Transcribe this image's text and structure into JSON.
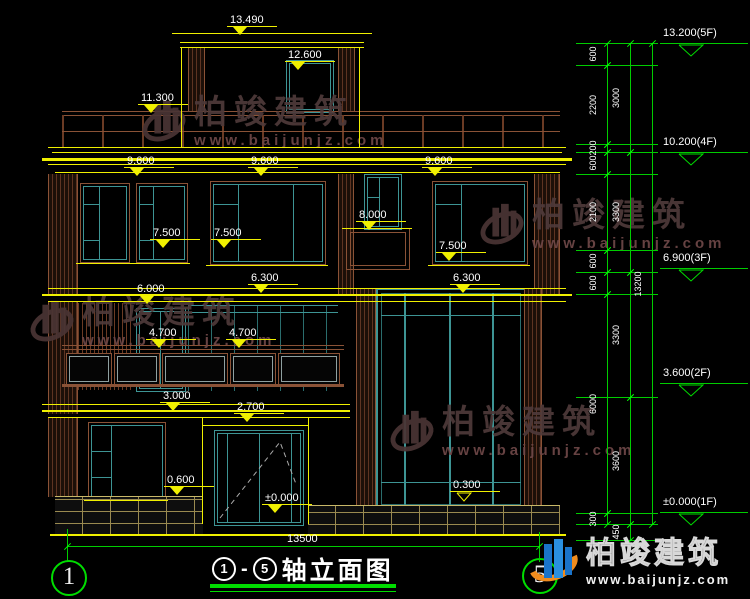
{
  "title": {
    "axis_from": "1",
    "dash": "-",
    "axis_to": "5",
    "text": "轴立面图"
  },
  "bottom": {
    "width_dim": "13500"
  },
  "axis_bubbles": {
    "left": "1",
    "right": "5"
  },
  "watermark": {
    "brand": "柏竣建筑",
    "url": "www.baijunjz.com"
  },
  "brand_logo": {
    "brand": "柏竣建筑",
    "url": "www.baijunjz.com"
  },
  "colors": {
    "cad_yellow": "#f0f000",
    "cad_green": "#00dd00",
    "frame_teal": "#3d9494",
    "wall_brown": "#8a5236",
    "watermark_red": "#4e3a3a",
    "logo_orange": "#f08c1e",
    "logo_blue": "#1a73c9"
  },
  "drawing": {
    "facade_labels": [
      {
        "text": "13.490",
        "x": 230,
        "y": 14
      },
      {
        "text": "12.600",
        "x": 288,
        "y": 49
      },
      {
        "text": "11.300",
        "x": 141,
        "y": 92
      },
      {
        "text": "9.600",
        "x": 127,
        "y": 155
      },
      {
        "text": "9.600",
        "x": 251,
        "y": 155
      },
      {
        "text": "9.600",
        "x": 425,
        "y": 155
      },
      {
        "text": "8.000",
        "x": 359,
        "y": 209
      },
      {
        "text": "7.500",
        "x": 153,
        "y": 227
      },
      {
        "text": "7.500",
        "x": 214,
        "y": 227
      },
      {
        "text": "7.500",
        "x": 439,
        "y": 240
      },
      {
        "text": "6.300",
        "x": 251,
        "y": 272
      },
      {
        "text": "6.300",
        "x": 453,
        "y": 272
      },
      {
        "text": "6.000",
        "x": 137,
        "y": 283
      },
      {
        "text": "4.700",
        "x": 149,
        "y": 327
      },
      {
        "text": "4.700",
        "x": 229,
        "y": 327
      },
      {
        "text": "3.000",
        "x": 163,
        "y": 390
      },
      {
        "text": "2.700",
        "x": 237,
        "y": 401
      },
      {
        "text": "0.600",
        "x": 167,
        "y": 474
      },
      {
        "text": "±0.000",
        "x": 265,
        "y": 492
      },
      {
        "text": "0.300",
        "x": 453,
        "y": 479,
        "open": true
      }
    ],
    "right_dimensions": {
      "levels": [
        43,
        65,
        144,
        152,
        174,
        250,
        272,
        294,
        397,
        513,
        524,
        540
      ],
      "chains": [
        {
          "x": 607,
          "segments": [
            {
              "from": 43,
              "to": 65,
              "label": "600"
            },
            {
              "from": 65,
              "to": 144,
              "label": "2200"
            },
            {
              "from": 144,
              "to": 152,
              "label": "200"
            },
            {
              "from": 152,
              "to": 174,
              "label": "600"
            },
            {
              "from": 174,
              "to": 250,
              "label": "2100"
            },
            {
              "from": 250,
              "to": 272,
              "label": "600"
            },
            {
              "from": 272,
              "to": 294,
              "label": "600"
            },
            {
              "from": 294,
              "to": 513,
              "label": "6000"
            },
            {
              "from": 513,
              "to": 524,
              "label": "300"
            }
          ]
        },
        {
          "x": 630,
          "segments": [
            {
              "from": 43,
              "to": 152,
              "label": "3000"
            },
            {
              "from": 152,
              "to": 272,
              "label": "3300"
            },
            {
              "from": 272,
              "to": 397,
              "label": "3300"
            },
            {
              "from": 397,
              "to": 524,
              "label": "3600"
            },
            {
              "from": 524,
              "to": 540,
              "label": "450"
            }
          ]
        },
        {
          "x": 652,
          "segments": [
            {
              "from": 43,
              "to": 524,
              "label": "13200"
            }
          ]
        }
      ],
      "markers": [
        {
          "label": "13.200(5F)",
          "y": 43
        },
        {
          "label": "10.200(4F)",
          "y": 152
        },
        {
          "label": "6.900(3F)",
          "y": 268
        },
        {
          "label": "3.600(2F)",
          "y": 383
        },
        {
          "label": "±0.000(1F)",
          "y": 512
        }
      ]
    }
  }
}
